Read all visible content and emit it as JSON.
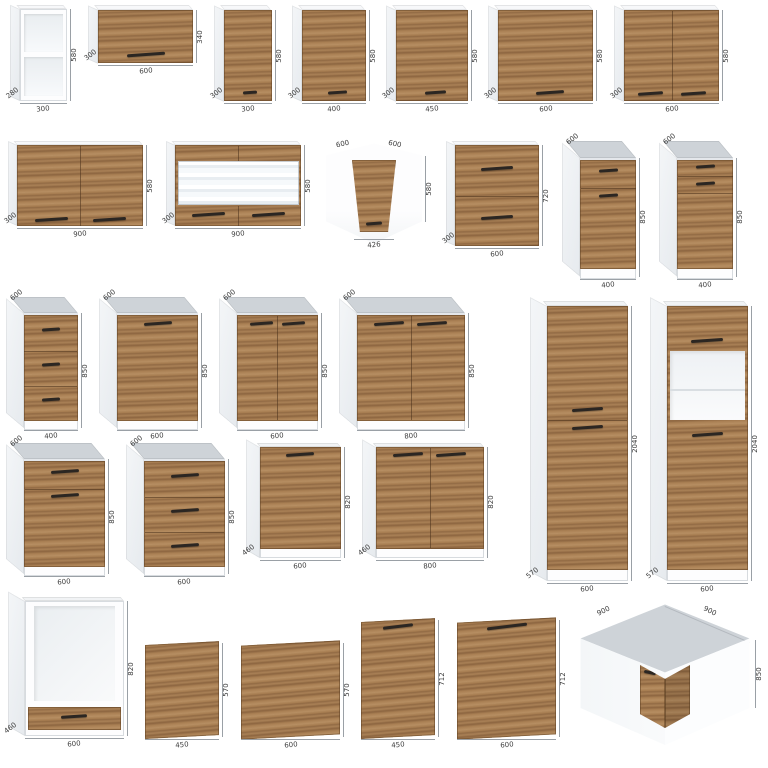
{
  "page": {
    "background": "#ffffff"
  },
  "colors": {
    "wood": "#a87f52",
    "carcass": "#ffffff",
    "side_shade": "#e9edf0",
    "wall_top": "#f7f8fa",
    "countertop": "#ced3d8",
    "inner": "#f2f4f6",
    "handle": "#2b2622",
    "dim_text": "#3c3c3c",
    "dim_line": "#9aa0a6"
  },
  "rows": [
    {
      "name": "wall-units-row",
      "items": [
        {
          "name": "open-shelf-wall-unit-300",
          "type": "wall",
          "front": "open",
          "w": 300,
          "h": 580,
          "d": 280,
          "dims": {
            "width": "300",
            "height": "580",
            "depth": "280"
          }
        },
        {
          "name": "flap-wall-unit-600",
          "type": "wall",
          "front": "flap",
          "w": 600,
          "h": 340,
          "d": 300,
          "dims": {
            "width": "600",
            "height": "340",
            "depth": "300"
          }
        },
        {
          "name": "wall-unit-300",
          "type": "wall",
          "front": "door",
          "w": 300,
          "h": 580,
          "d": 300,
          "dims": {
            "width": "300",
            "height": "580",
            "depth": "300"
          }
        },
        {
          "name": "wall-unit-400",
          "type": "wall",
          "front": "door",
          "w": 400,
          "h": 580,
          "d": 300,
          "dims": {
            "width": "400",
            "height": "580",
            "depth": "300"
          }
        },
        {
          "name": "wall-unit-450",
          "type": "wall",
          "front": "door",
          "w": 450,
          "h": 580,
          "d": 300,
          "dims": {
            "width": "450",
            "height": "580",
            "depth": "300"
          }
        },
        {
          "name": "wall-unit-600",
          "type": "wall",
          "front": "door",
          "w": 600,
          "h": 580,
          "d": 300,
          "dims": {
            "width": "600",
            "height": "580",
            "depth": "300"
          }
        },
        {
          "name": "wall-unit-600-two-door",
          "type": "wall",
          "front": "door2",
          "w": 600,
          "h": 580,
          "d": 300,
          "dims": {
            "width": "600",
            "height": "580",
            "depth": "300"
          }
        }
      ]
    },
    {
      "name": "wall-corner-base-row",
      "items": [
        {
          "name": "wall-unit-900-two-door",
          "type": "wall",
          "front": "door2",
          "w": 900,
          "h": 580,
          "d": 300,
          "dims": {
            "width": "900",
            "height": "580",
            "depth": "300"
          }
        },
        {
          "name": "glass-wall-unit-900",
          "type": "wall",
          "front": "glass",
          "w": 900,
          "h": 580,
          "d": 300,
          "dims": {
            "width": "900",
            "height": "580",
            "depth": "300"
          }
        },
        {
          "name": "corner-wall-unit-600",
          "type": "corner-wall",
          "dims": {
            "left": "600",
            "right": "600",
            "height": "580",
            "door": "426"
          }
        },
        {
          "name": "flap-wall-unit-600-720",
          "type": "wall",
          "front": "flap2",
          "w": 600,
          "h": 720,
          "d": 300,
          "dims": {
            "width": "600",
            "height": "720",
            "depth": "300"
          }
        },
        {
          "name": "base-unit-400-drawer-door",
          "type": "base",
          "front": "drawer-door",
          "w": 400,
          "h": 850,
          "d": 600,
          "dims": {
            "width": "400",
            "height": "850",
            "top_depth": "600"
          }
        },
        {
          "name": "base-unit-400-two-drawer-door",
          "type": "base",
          "front": "drawer2-door",
          "w": 400,
          "h": 850,
          "d": 600,
          "dims": {
            "width": "400",
            "height": "850",
            "top_depth": "600"
          }
        }
      ]
    },
    {
      "name": "base-units-row-1",
      "items": [
        {
          "name": "base-unit-400-three-drawers",
          "type": "base",
          "front": "drawer3",
          "w": 400,
          "h": 850,
          "d": 600,
          "dims": {
            "width": "400",
            "height": "850",
            "top_depth": "600"
          }
        },
        {
          "name": "base-unit-600-door",
          "type": "base",
          "front": "door-base",
          "w": 600,
          "h": 850,
          "d": 600,
          "dims": {
            "width": "600",
            "height": "850",
            "top_depth": "600"
          }
        },
        {
          "name": "base-unit-600-two-door",
          "type": "base",
          "front": "door2-base",
          "w": 600,
          "h": 850,
          "d": 600,
          "dims": {
            "width": "600",
            "height": "850",
            "top_depth": "600"
          }
        },
        {
          "name": "base-unit-800-two-door",
          "type": "base",
          "front": "door2-base",
          "w": 800,
          "h": 850,
          "d": 600,
          "dims": {
            "width": "800",
            "height": "850",
            "top_depth": "600"
          }
        }
      ]
    },
    {
      "name": "base-units-row-2",
      "items": [
        {
          "name": "base-unit-600-drawer-door",
          "type": "base",
          "front": "drawer-door",
          "w": 600,
          "h": 850,
          "d": 600,
          "dims": {
            "width": "600",
            "height": "850",
            "top_depth": "600"
          }
        },
        {
          "name": "base-unit-600-three-drawers",
          "type": "base",
          "front": "drawer3",
          "w": 600,
          "h": 850,
          "d": 600,
          "dims": {
            "width": "600",
            "height": "850",
            "top_depth": "600"
          }
        },
        {
          "name": "base-unit-600-door-no-top",
          "type": "base-nc",
          "front": "door-base",
          "w": 600,
          "h": 820,
          "d": 460,
          "dims": {
            "width": "600",
            "height": "820",
            "depth": "460"
          }
        },
        {
          "name": "base-unit-800-two-door-no-top",
          "type": "base-nc",
          "front": "door2-base",
          "w": 800,
          "h": 820,
          "d": 460,
          "dims": {
            "width": "800",
            "height": "820",
            "depth": "460"
          }
        }
      ]
    },
    {
      "name": "tall-units-column",
      "items": [
        {
          "name": "tall-unit-600-two-door",
          "type": "tall",
          "front": "tall2",
          "w": 600,
          "h": 2040,
          "d": 570,
          "dims": {
            "width": "600",
            "height": "2040",
            "depth": "570"
          }
        },
        {
          "name": "tall-oven-housing-600",
          "type": "tall",
          "front": "tall-oven",
          "w": 600,
          "h": 2040,
          "d": 570,
          "dims": {
            "width": "600",
            "height": "2040",
            "depth": "570"
          }
        }
      ]
    },
    {
      "name": "bottom-row",
      "items": [
        {
          "name": "oven-housing-base-600",
          "type": "base-nc",
          "front": "oven-base",
          "w": 600,
          "h": 820,
          "d": 460,
          "dims": {
            "width": "600",
            "height": "820",
            "depth": "460"
          }
        },
        {
          "name": "front-panel-450-570",
          "type": "panel",
          "front": "panel",
          "w": 450,
          "h": 570,
          "dims": {
            "width": "450",
            "height": "570"
          }
        },
        {
          "name": "front-panel-600-570",
          "type": "panel",
          "front": "panel",
          "w": 600,
          "h": 570,
          "dims": {
            "width": "600",
            "height": "570"
          }
        },
        {
          "name": "dishwasher-front-450-712",
          "type": "panel",
          "front": "panel-h",
          "w": 450,
          "h": 712,
          "dims": {
            "width": "450",
            "height": "712"
          }
        },
        {
          "name": "dishwasher-front-600-712",
          "type": "panel",
          "front": "panel-h",
          "w": 600,
          "h": 712,
          "dims": {
            "width": "600",
            "height": "712"
          }
        },
        {
          "name": "corner-base-unit-900",
          "type": "corner-base",
          "dims": {
            "left": "900",
            "right": "900",
            "height": "850"
          }
        }
      ]
    }
  ]
}
